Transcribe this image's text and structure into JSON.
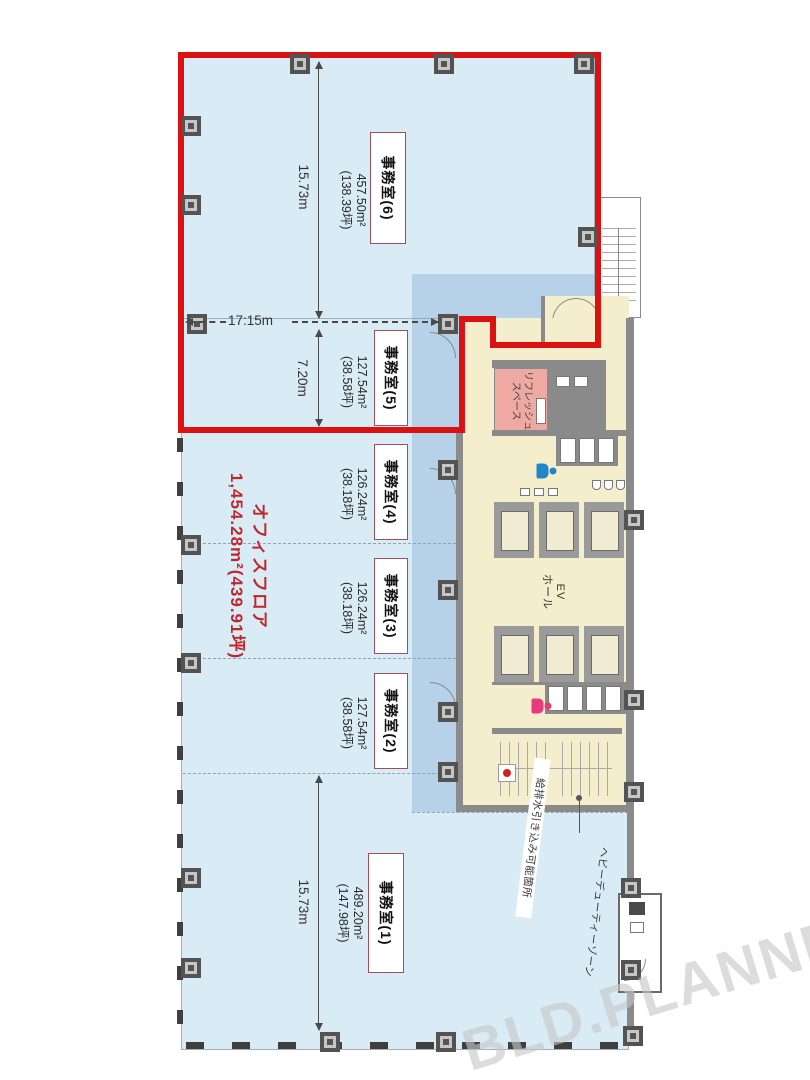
{
  "watermark": "BLD.PLANNER",
  "summary": {
    "label": "オフィスフロア",
    "area": "1,454.28m²(439.91坪)"
  },
  "rooms": [
    {
      "label": "事務室(6)",
      "area_m2": "457.50m²",
      "area_tsubo": "(138.39坪)"
    },
    {
      "label": "事務室(5)",
      "area_m2": "127.54m²",
      "area_tsubo": "(38.58坪)"
    },
    {
      "label": "事務室(4)",
      "area_m2": "126.24m²",
      "area_tsubo": "(38.18坪)"
    },
    {
      "label": "事務室(3)",
      "area_m2": "126.24m²",
      "area_tsubo": "(38.18坪)"
    },
    {
      "label": "事務室(2)",
      "area_m2": "127.54m²",
      "area_tsubo": "(38.58坪)"
    },
    {
      "label": "事務室(1)",
      "area_m2": "489.20m²",
      "area_tsubo": "(147.98坪)"
    }
  ],
  "dimensions": {
    "upper_depth": "15.73m",
    "width": "17:15m",
    "room5_depth": "7.20m",
    "lower_depth": "15.73m"
  },
  "core": {
    "ev_hall_line1": "EV",
    "ev_hall_line2": "ホール",
    "refresh_line1": "リフレッシュ",
    "refresh_line2": "スペース"
  },
  "annotations": {
    "plumbing": "給排水引き込み可能箇所",
    "heavy_duty": "ヘビーデューティーゾーン"
  },
  "colors": {
    "highlight_red": "#dc1111",
    "office_fill": "#d9ecf6",
    "overlay_fill": "#aac8e2",
    "core_fill": "#f4eecd",
    "refresh_fill": "#efa9a3",
    "summary_text": "#c0272d",
    "wall_gray": "#8a8a8a",
    "watermark_gray": "#cccccc"
  }
}
